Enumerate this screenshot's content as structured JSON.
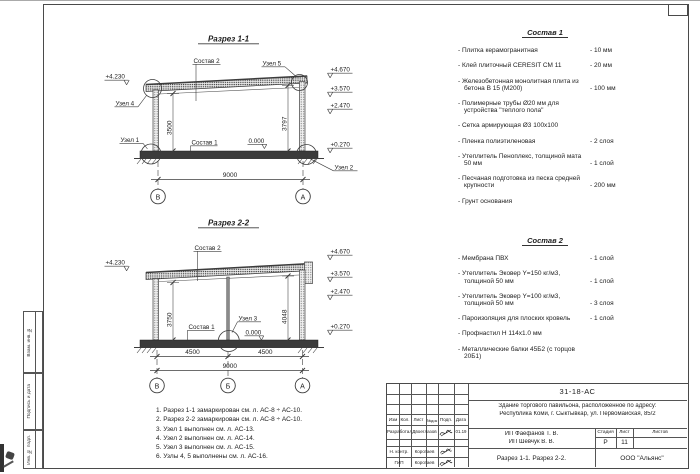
{
  "sheet": {
    "side_labels": [
      "Взам. инв. №",
      "Подпись и дата",
      "Инв. № подл."
    ]
  },
  "section1": {
    "title": "Разрез 1-1",
    "elev_left": "+4.230",
    "elevations": [
      "+4.670",
      "+3.570",
      "+2.470",
      "+0.270"
    ],
    "zero": "0.000",
    "dim_left": "3500",
    "dim_right": "3797",
    "dim_span": "9000",
    "axes": [
      "В",
      "А"
    ],
    "callouts": {
      "sostav2": "Состав 2",
      "sostav1": "Состав 1",
      "uzel1": "Узел 1",
      "uzel2": "Узел 2",
      "uzel4": "Узел 4",
      "uzel5": "Узел 5"
    }
  },
  "section2": {
    "title": "Разрез 2-2",
    "elev_left": "+4.230",
    "elevations": [
      "+4.670",
      "+3.570",
      "+2.470",
      "+0.270"
    ],
    "zero": "0.000",
    "dim_left": "3750",
    "dim_right": "4048",
    "dim_bays": [
      "4500",
      "4500"
    ],
    "dim_span": "9000",
    "axes": [
      "В",
      "Б",
      "А"
    ],
    "callouts": {
      "sostav2": "Состав 2",
      "sostav1": "Состав 1",
      "uzel3": "Узел 3"
    }
  },
  "sostav1": {
    "title": "Состав 1",
    "items": [
      {
        "name": "- Плитка керамогранитная",
        "value": "- 10 мм"
      },
      {
        "name": "- Клей плиточный CERESIT CM 11",
        "value": "- 20 мм"
      },
      {
        "name": "- Железобетонная  монолитная плита из бетона В 15 (М200)",
        "value": "- 100 мм"
      },
      {
        "name": "- Полимерные трубы Ø20 мм для устройства \"теплого пола\"",
        "value": ""
      },
      {
        "name": "- Сетка армирующая Ø3 100х100",
        "value": ""
      },
      {
        "name": "- Пленка полиэтиленовая",
        "value": "- 2 слоя"
      },
      {
        "name": "- Утеплитель Пеноплекс, толщиной мата 50 мм",
        "value": "- 1 слой"
      },
      {
        "name": "- Песчаная подготовка из песка средней крупности",
        "value": "- 200 мм"
      },
      {
        "name": "- Грунт основания",
        "value": ""
      }
    ]
  },
  "sostav2": {
    "title": "Состав 2",
    "items": [
      {
        "name": "- Мембрана ПВХ",
        "value": "- 1 слой"
      },
      {
        "name": "- Утеплитель Эковер Y=150 кг/м3, толщиной 50 мм",
        "value": "- 1 слой"
      },
      {
        "name": "- Утеплитель Эковер Y=100 кг/м3, толщиной 50 мм",
        "value": "- 3 слоя"
      },
      {
        "name": "- Пароизоляция для плоских кровель",
        "value": "- 1 слой"
      },
      {
        "name": "- Профнастил Н 114х1.0 мм",
        "value": ""
      },
      {
        "name": "- Металлические балки 45Б2 (с торцов 20Б1)",
        "value": ""
      }
    ]
  },
  "notes": [
    "1. Разрез 1-1 замаркирован см. л. АС-8 ÷ АС-10.",
    "2. Разрез 2-2 замаркирован см. л. АС-8 ÷ АС-10.",
    "3. Узел 1 выполнен см. л. АС-13.",
    "4. Узел 2 выполнен см. л. АС-14.",
    "5. Узел 3 выполнен см. л. АС-15.",
    "6. Узлы 4, 5 выполнены см. л. АС-16."
  ],
  "titleblock": {
    "doc_number": "31-18-АС",
    "object_line1": "Здание торгового павильона, расположенное по адресу:",
    "object_line2": "Республика Коми, г. Сыктывкар, ул. Первомайская, 85/2",
    "client_line1": "ИП Фаефанов Т. В.",
    "client_line2": "ИП Шевчук В. В.",
    "columns": [
      "Изм",
      "Кол.",
      "Лист",
      "№док",
      "Подп.",
      "Дата"
    ],
    "stage_label": "Стадия",
    "sheet_label": "Лист",
    "sheets_label": "Листов",
    "stage": "Р",
    "sheet_num": "11",
    "rows": [
      {
        "role": "Разработал",
        "name": "Двоеглазов",
        "date": "01.19"
      },
      {
        "role": "Н. контр.",
        "name": "Коротаев",
        "date": ""
      },
      {
        "role": "ГИП",
        "name": "Коротаев",
        "date": ""
      }
    ],
    "drawing_title": "Разрез 1-1. Разрез 2-2.",
    "company": "ООО \"Альянс\""
  }
}
